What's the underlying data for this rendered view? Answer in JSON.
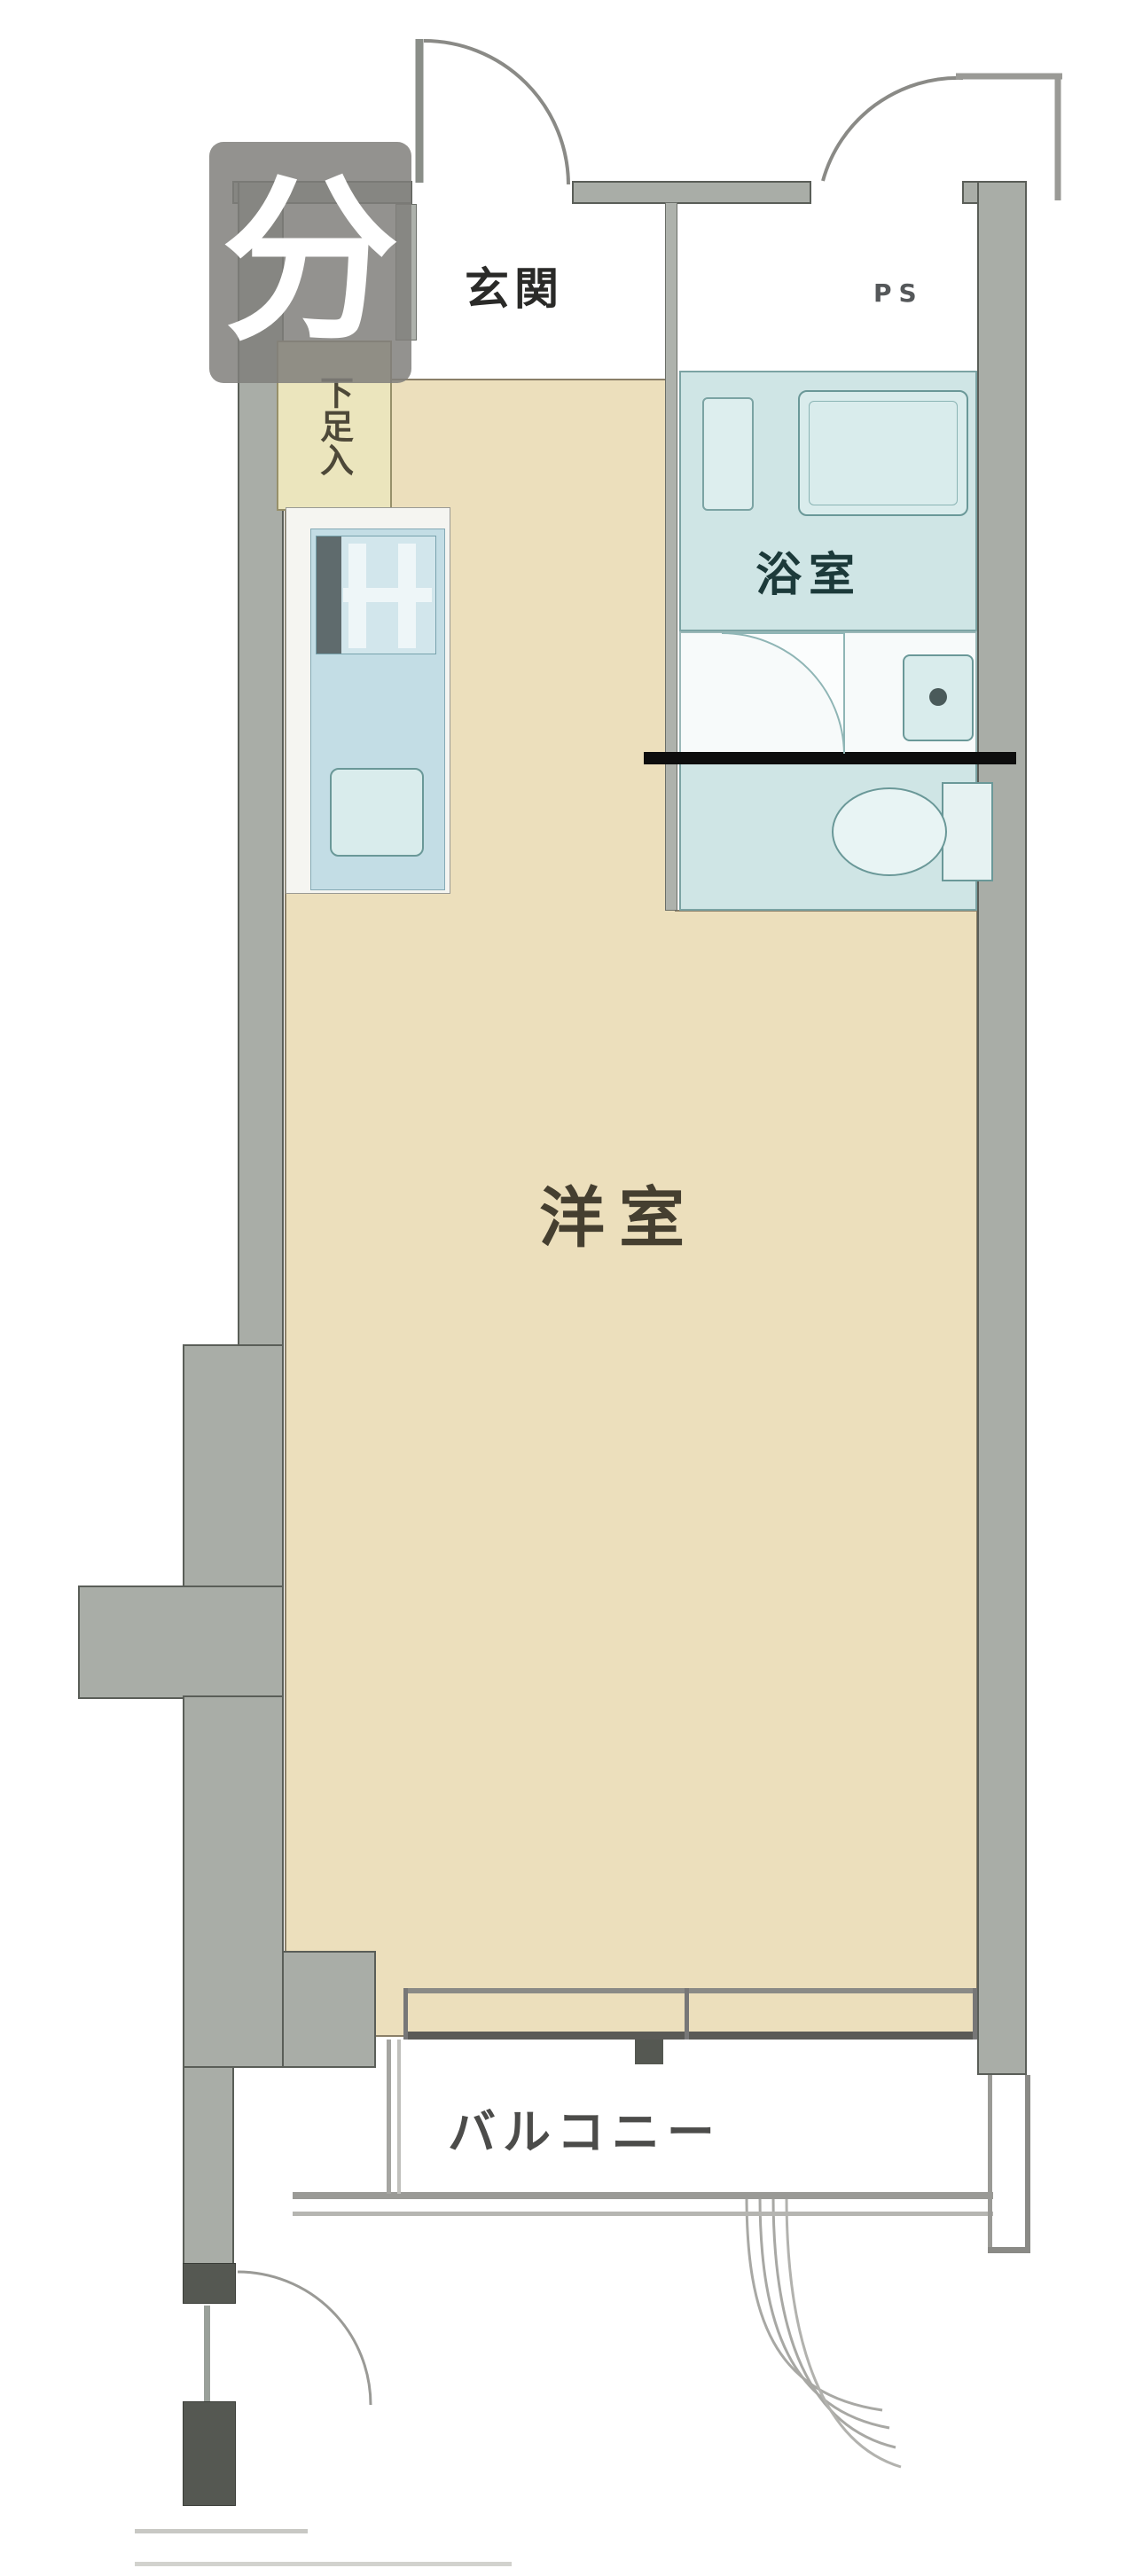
{
  "floorplan": {
    "labels": {
      "entrance": "玄関",
      "shoe_cupboard": "下足入",
      "bathroom": "浴室",
      "pipe_space": "PS",
      "western_room": "洋室",
      "balcony": "バルコニー"
    },
    "watermark": {
      "glyph": "分"
    },
    "colors": {
      "wall": "#a9ada7",
      "wall_dark": "#555852",
      "room_floor": "#ecdfbc",
      "room_floor_border": "#8a7f68",
      "wet_area": "#cfe5e5",
      "wet_area_border": "#7ba3a3",
      "kitchen_unit": "#c3dde5",
      "shoe_cupboard": "#ebe5bd",
      "divider_line": "#0d0d0d",
      "watermark_bg": "#807f7b"
    }
  }
}
